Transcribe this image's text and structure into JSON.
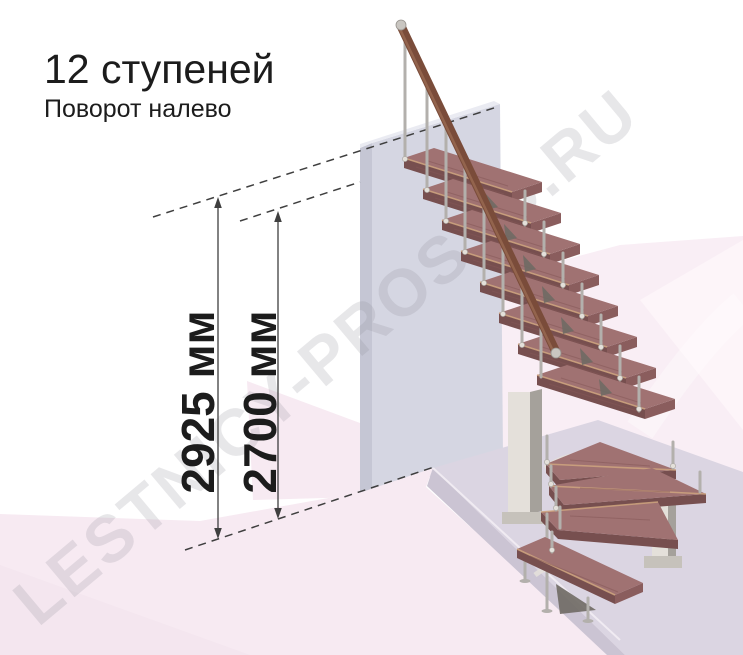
{
  "title": {
    "heading": "12 ступеней",
    "subheading": "Поворот налево"
  },
  "watermark": {
    "text": "LESTNICY-PROSTO.RU"
  },
  "dimensions": {
    "total_height": {
      "label": "2925 мм"
    },
    "walk_height": {
      "label": "2700 мм"
    }
  },
  "stair": {
    "steps_total": 12,
    "turn_direction_label": "налево"
  },
  "colors": {
    "wood_top": "#a07272",
    "wood_front": "#774f4f",
    "wood_side": "#8a5d5d",
    "wood_nose": "#cfa57f",
    "rail": "#7a4c3a",
    "metal_light": "#e4e0da",
    "metal_mid": "#b3b0ac",
    "metal_dark": "#a5a19b",
    "metal_shadow": "#6f6a64",
    "wall_face": "#d5d6e2",
    "wall_side": "#c5c6d4",
    "floor_pink": "#f7eaf2",
    "floor_pink_right": "#f9eef5",
    "plinth_top": "#dbd5e2",
    "plinth_front": "#cbc4d3",
    "dim_line": "#3f3f3f",
    "text": "#1c1c1c",
    "watermark": "#8c8c96"
  }
}
